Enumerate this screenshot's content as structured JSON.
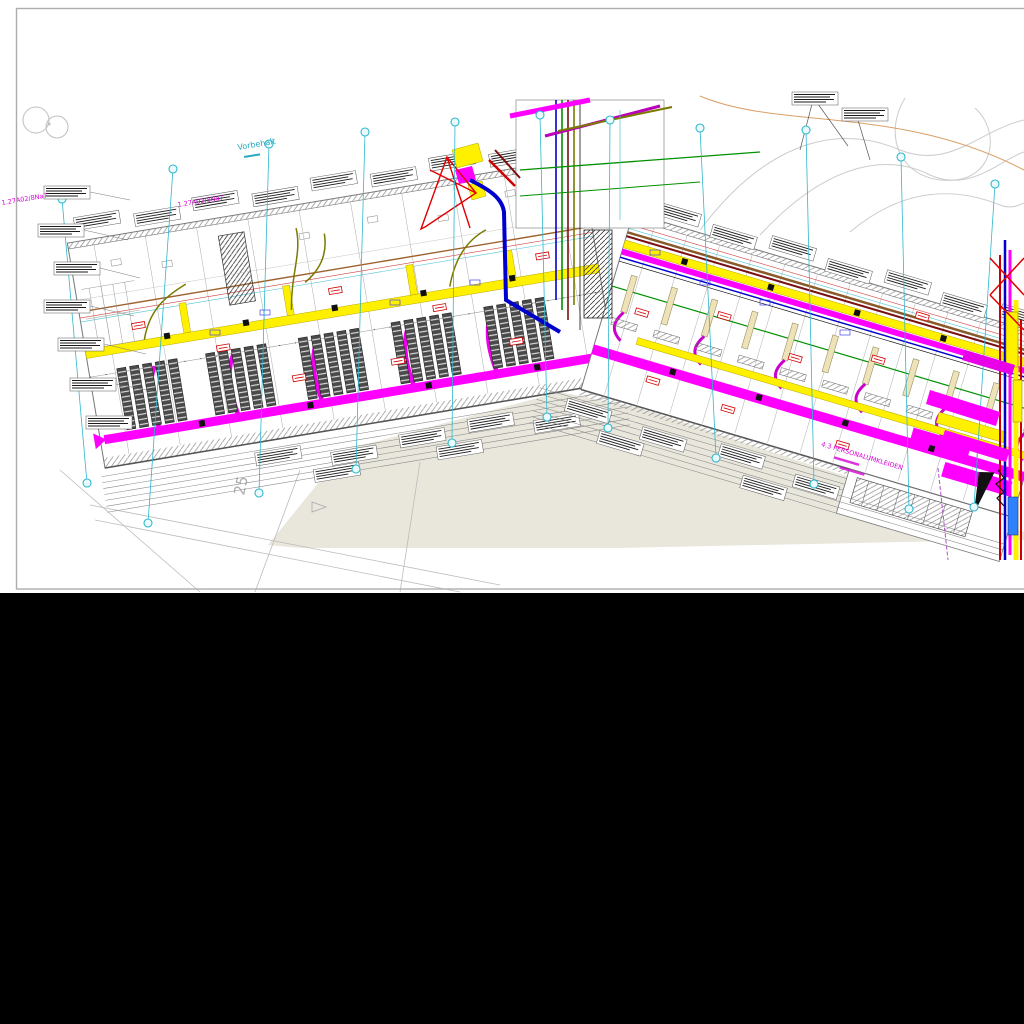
{
  "page": {
    "background": "#FFFFFF",
    "frame_color": "#ADADAD",
    "letterbox_color": "#000000"
  },
  "drawing": {
    "labels": {
      "reservation_note": "Vorbehalt",
      "pipe_route_tag": "1.27A02/8Na7",
      "site_grid_number": "25",
      "room_zone_label": "4.3 PERSONALUMKLEIDEN"
    },
    "colors": {
      "supply_duct_magenta": "#FF00FF",
      "exhaust_duct_yellow": "#FFF000",
      "grid_cyan": "#2FB7CE",
      "alarm_red": "#E00000",
      "pipe_green": "#009000",
      "pipe_blue": "#0000CC",
      "pipe_maroon": "#7A1010",
      "pipe_olive": "#7A7A00",
      "pipe_brown": "#A0622D",
      "ground_beige": "#E9E6DC",
      "contour_gray": "#CCCCCC"
    }
  }
}
